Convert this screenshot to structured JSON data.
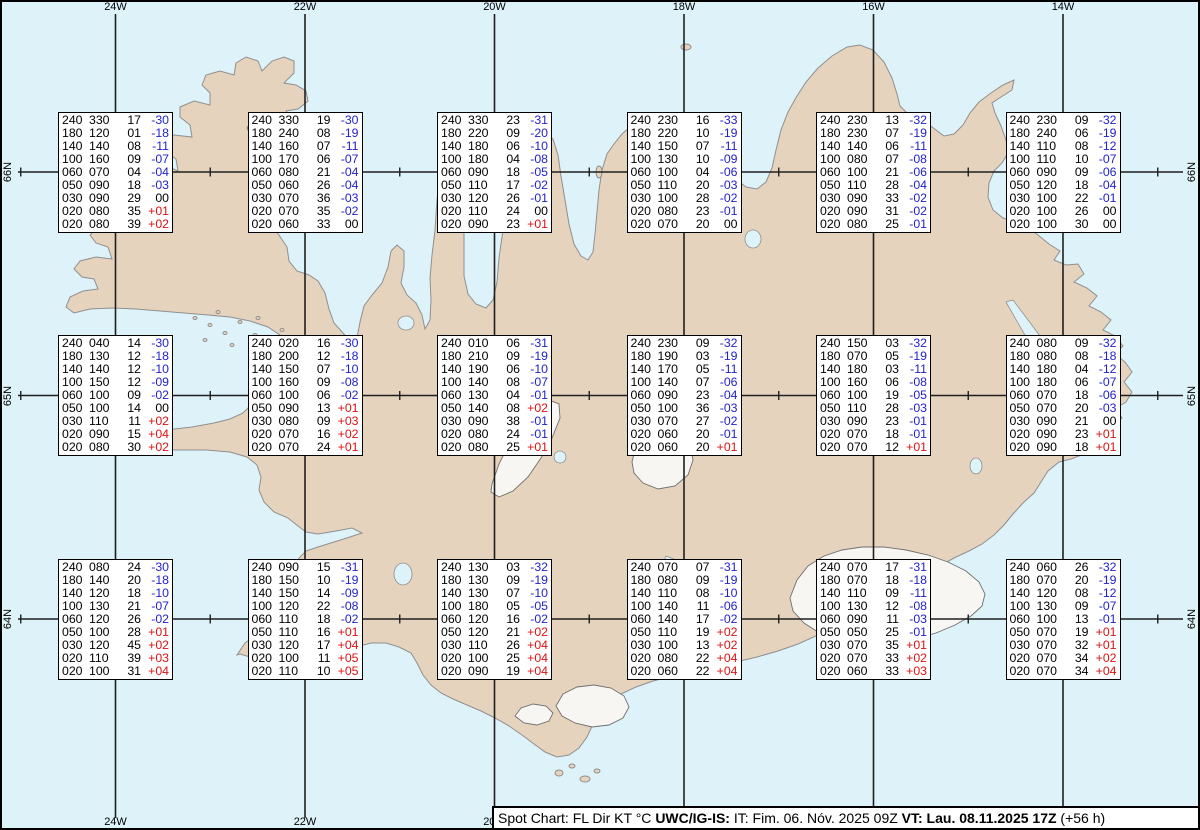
{
  "title": "Spot Chart Iceland",
  "colors": {
    "sea": "#def2f9",
    "land": "#e6d3be",
    "coastline": "#8f8f8f",
    "glacier_outline": "#6f6f6f",
    "glacier_fill": "#f7f6f2",
    "grid_line": "#1f1f1f",
    "box_background": "#ffffff",
    "box_border": "#000000",
    "text": "#000000",
    "temp_negative": "#2222cc",
    "temp_positive": "#dd1111"
  },
  "grid": {
    "meridians": [
      {
        "label": "24W",
        "x": 115.5
      },
      {
        "label": "22W",
        "x": 305
      },
      {
        "label": "20W",
        "x": 494.5
      },
      {
        "label": "18W",
        "x": 684
      },
      {
        "label": "16W",
        "x": 873.5
      },
      {
        "label": "14W",
        "x": 1063
      }
    ],
    "parallels": [
      {
        "label": "66N",
        "y": 172
      },
      {
        "label": "65N",
        "y": 395.5
      },
      {
        "label": "64N",
        "y": 619
      }
    ],
    "meridian_y1": 14,
    "meridian_y2": 818,
    "parallel_x1": 18,
    "parallel_x2": 1183,
    "tick_x": [
      20.75,
      210.25,
      399.75,
      589.25,
      778.75,
      968.25,
      1157.75
    ],
    "top_label_y": 1,
    "bottom_label_y": 816,
    "left_label_x": 8,
    "right_label_x": 1192
  },
  "columns": [
    "FL",
    "Dir",
    "KT",
    "°C"
  ],
  "stations": [
    {
      "lat": "66N",
      "lon": "24W",
      "levels": [
        [
          "240",
          "330",
          "17",
          "-30"
        ],
        [
          "180",
          "120",
          "01",
          "-18"
        ],
        [
          "140",
          "140",
          "08",
          "-11"
        ],
        [
          "100",
          "160",
          "09",
          "-07"
        ],
        [
          "060",
          "070",
          "04",
          "-04"
        ],
        [
          "050",
          "090",
          "18",
          "-03"
        ],
        [
          "030",
          "090",
          "29",
          "00"
        ],
        [
          "020",
          "080",
          "35",
          "+01"
        ],
        [
          "020",
          "080",
          "39",
          "+02"
        ]
      ]
    },
    {
      "lat": "66N",
      "lon": "22W",
      "levels": [
        [
          "240",
          "330",
          "19",
          "-30"
        ],
        [
          "180",
          "240",
          "08",
          "-19"
        ],
        [
          "140",
          "160",
          "07",
          "-11"
        ],
        [
          "100",
          "170",
          "06",
          "-07"
        ],
        [
          "060",
          "080",
          "21",
          "-04"
        ],
        [
          "050",
          "060",
          "26",
          "-04"
        ],
        [
          "030",
          "070",
          "36",
          "-03"
        ],
        [
          "020",
          "070",
          "35",
          "-02"
        ],
        [
          "020",
          "060",
          "33",
          "00"
        ]
      ]
    },
    {
      "lat": "66N",
      "lon": "20W",
      "levels": [
        [
          "240",
          "330",
          "23",
          "-31"
        ],
        [
          "180",
          "220",
          "09",
          "-20"
        ],
        [
          "140",
          "180",
          "06",
          "-10"
        ],
        [
          "100",
          "180",
          "04",
          "-08"
        ],
        [
          "060",
          "090",
          "18",
          "-05"
        ],
        [
          "050",
          "110",
          "17",
          "-02"
        ],
        [
          "030",
          "120",
          "26",
          "-01"
        ],
        [
          "020",
          "110",
          "24",
          "00"
        ],
        [
          "020",
          "090",
          "23",
          "+01"
        ]
      ]
    },
    {
      "lat": "66N",
      "lon": "18W",
      "levels": [
        [
          "240",
          "230",
          "16",
          "-33"
        ],
        [
          "180",
          "220",
          "10",
          "-19"
        ],
        [
          "140",
          "150",
          "07",
          "-11"
        ],
        [
          "100",
          "130",
          "10",
          "-09"
        ],
        [
          "060",
          "100",
          "04",
          "-06"
        ],
        [
          "050",
          "110",
          "20",
          "-03"
        ],
        [
          "030",
          "100",
          "28",
          "-02"
        ],
        [
          "020",
          "080",
          "23",
          "-01"
        ],
        [
          "020",
          "070",
          "20",
          "00"
        ]
      ]
    },
    {
      "lat": "66N",
      "lon": "16W",
      "levels": [
        [
          "240",
          "230",
          "13",
          "-32"
        ],
        [
          "180",
          "230",
          "07",
          "-19"
        ],
        [
          "140",
          "140",
          "06",
          "-11"
        ],
        [
          "100",
          "080",
          "07",
          "-08"
        ],
        [
          "060",
          "100",
          "21",
          "-06"
        ],
        [
          "050",
          "110",
          "28",
          "-04"
        ],
        [
          "030",
          "090",
          "33",
          "-02"
        ],
        [
          "020",
          "090",
          "31",
          "-02"
        ],
        [
          "020",
          "080",
          "25",
          "-01"
        ]
      ]
    },
    {
      "lat": "66N",
      "lon": "14W",
      "levels": [
        [
          "240",
          "230",
          "09",
          "-32"
        ],
        [
          "180",
          "240",
          "06",
          "-19"
        ],
        [
          "140",
          "110",
          "08",
          "-12"
        ],
        [
          "100",
          "110",
          "10",
          "-07"
        ],
        [
          "060",
          "090",
          "09",
          "-06"
        ],
        [
          "050",
          "120",
          "18",
          "-04"
        ],
        [
          "030",
          "100",
          "22",
          "-01"
        ],
        [
          "020",
          "100",
          "26",
          "00"
        ],
        [
          "020",
          "100",
          "30",
          "00"
        ]
      ]
    },
    {
      "lat": "65N",
      "lon": "24W",
      "levels": [
        [
          "240",
          "040",
          "14",
          "-30"
        ],
        [
          "180",
          "130",
          "12",
          "-18"
        ],
        [
          "140",
          "140",
          "12",
          "-10"
        ],
        [
          "100",
          "150",
          "12",
          "-09"
        ],
        [
          "060",
          "100",
          "09",
          "-02"
        ],
        [
          "050",
          "100",
          "14",
          "00"
        ],
        [
          "030",
          "110",
          "11",
          "+02"
        ],
        [
          "020",
          "090",
          "15",
          "+04"
        ],
        [
          "020",
          "080",
          "30",
          "+02"
        ]
      ]
    },
    {
      "lat": "65N",
      "lon": "22W",
      "levels": [
        [
          "240",
          "020",
          "16",
          "-30"
        ],
        [
          "180",
          "200",
          "12",
          "-18"
        ],
        [
          "140",
          "150",
          "07",
          "-10"
        ],
        [
          "100",
          "160",
          "09",
          "-08"
        ],
        [
          "060",
          "100",
          "06",
          "-02"
        ],
        [
          "050",
          "090",
          "13",
          "+01"
        ],
        [
          "030",
          "080",
          "09",
          "+03"
        ],
        [
          "020",
          "070",
          "16",
          "+02"
        ],
        [
          "020",
          "070",
          "24",
          "+01"
        ]
      ]
    },
    {
      "lat": "65N",
      "lon": "20W",
      "levels": [
        [
          "240",
          "010",
          "06",
          "-31"
        ],
        [
          "180",
          "210",
          "09",
          "-19"
        ],
        [
          "140",
          "190",
          "06",
          "-10"
        ],
        [
          "100",
          "140",
          "08",
          "-07"
        ],
        [
          "060",
          "130",
          "04",
          "-01"
        ],
        [
          "050",
          "140",
          "08",
          "+02"
        ],
        [
          "030",
          "090",
          "38",
          "-01"
        ],
        [
          "020",
          "080",
          "24",
          "-01"
        ],
        [
          "020",
          "080",
          "25",
          "+01"
        ]
      ]
    },
    {
      "lat": "65N",
      "lon": "18W",
      "levels": [
        [
          "240",
          "230",
          "09",
          "-32"
        ],
        [
          "180",
          "190",
          "03",
          "-19"
        ],
        [
          "140",
          "170",
          "05",
          "-11"
        ],
        [
          "100",
          "140",
          "07",
          "-06"
        ],
        [
          "060",
          "090",
          "23",
          "-04"
        ],
        [
          "050",
          "100",
          "36",
          "-03"
        ],
        [
          "030",
          "070",
          "27",
          "-02"
        ],
        [
          "020",
          "060",
          "20",
          "-01"
        ],
        [
          "020",
          "060",
          "20",
          "+01"
        ]
      ]
    },
    {
      "lat": "65N",
      "lon": "16W",
      "levels": [
        [
          "240",
          "150",
          "03",
          "-32"
        ],
        [
          "180",
          "070",
          "05",
          "-19"
        ],
        [
          "140",
          "180",
          "03",
          "-11"
        ],
        [
          "100",
          "160",
          "06",
          "-08"
        ],
        [
          "060",
          "100",
          "19",
          "-05"
        ],
        [
          "050",
          "110",
          "28",
          "-03"
        ],
        [
          "030",
          "090",
          "23",
          "-01"
        ],
        [
          "020",
          "070",
          "18",
          "-01"
        ],
        [
          "020",
          "070",
          "12",
          "+01"
        ]
      ]
    },
    {
      "lat": "65N",
      "lon": "14W",
      "levels": [
        [
          "240",
          "080",
          "09",
          "-32"
        ],
        [
          "180",
          "080",
          "08",
          "-18"
        ],
        [
          "140",
          "180",
          "04",
          "-12"
        ],
        [
          "100",
          "180",
          "06",
          "-07"
        ],
        [
          "060",
          "070",
          "18",
          "-06"
        ],
        [
          "050",
          "070",
          "20",
          "-03"
        ],
        [
          "030",
          "090",
          "21",
          "00"
        ],
        [
          "020",
          "090",
          "23",
          "+01"
        ],
        [
          "020",
          "090",
          "18",
          "+01"
        ]
      ]
    },
    {
      "lat": "64N",
      "lon": "24W",
      "levels": [
        [
          "240",
          "080",
          "24",
          "-30"
        ],
        [
          "180",
          "140",
          "20",
          "-18"
        ],
        [
          "140",
          "120",
          "18",
          "-10"
        ],
        [
          "100",
          "130",
          "21",
          "-07"
        ],
        [
          "060",
          "120",
          "26",
          "-02"
        ],
        [
          "050",
          "100",
          "28",
          "+01"
        ],
        [
          "030",
          "120",
          "45",
          "+02"
        ],
        [
          "020",
          "110",
          "39",
          "+03"
        ],
        [
          "020",
          "100",
          "31",
          "+04"
        ]
      ]
    },
    {
      "lat": "64N",
      "lon": "22W",
      "levels": [
        [
          "240",
          "090",
          "15",
          "-31"
        ],
        [
          "180",
          "150",
          "10",
          "-19"
        ],
        [
          "140",
          "150",
          "14",
          "-09"
        ],
        [
          "100",
          "120",
          "22",
          "-08"
        ],
        [
          "060",
          "110",
          "18",
          "-02"
        ],
        [
          "050",
          "110",
          "16",
          "+01"
        ],
        [
          "030",
          "120",
          "17",
          "+04"
        ],
        [
          "020",
          "100",
          "11",
          "+05"
        ],
        [
          "020",
          "110",
          "10",
          "+05"
        ]
      ]
    },
    {
      "lat": "64N",
      "lon": "20W",
      "levels": [
        [
          "240",
          "130",
          "03",
          "-32"
        ],
        [
          "180",
          "130",
          "09",
          "-19"
        ],
        [
          "140",
          "130",
          "07",
          "-10"
        ],
        [
          "100",
          "180",
          "05",
          "-05"
        ],
        [
          "060",
          "120",
          "16",
          "-02"
        ],
        [
          "050",
          "120",
          "21",
          "+02"
        ],
        [
          "030",
          "110",
          "26",
          "+04"
        ],
        [
          "020",
          "100",
          "25",
          "+04"
        ],
        [
          "020",
          "090",
          "19",
          "+04"
        ]
      ]
    },
    {
      "lat": "64N",
      "lon": "18W",
      "levels": [
        [
          "240",
          "070",
          "07",
          "-31"
        ],
        [
          "180",
          "080",
          "09",
          "-19"
        ],
        [
          "140",
          "110",
          "08",
          "-10"
        ],
        [
          "100",
          "140",
          "11",
          "-06"
        ],
        [
          "060",
          "140",
          "17",
          "-02"
        ],
        [
          "050",
          "110",
          "19",
          "+02"
        ],
        [
          "030",
          "100",
          "13",
          "+02"
        ],
        [
          "020",
          "080",
          "22",
          "+04"
        ],
        [
          "020",
          "060",
          "22",
          "+04"
        ]
      ]
    },
    {
      "lat": "64N",
      "lon": "16W",
      "levels": [
        [
          "240",
          "070",
          "17",
          "-31"
        ],
        [
          "180",
          "070",
          "18",
          "-18"
        ],
        [
          "140",
          "110",
          "09",
          "-11"
        ],
        [
          "100",
          "130",
          "12",
          "-08"
        ],
        [
          "060",
          "090",
          "11",
          "-03"
        ],
        [
          "050",
          "050",
          "25",
          "-01"
        ],
        [
          "030",
          "070",
          "35",
          "+01"
        ],
        [
          "020",
          "070",
          "33",
          "+02"
        ],
        [
          "020",
          "060",
          "33",
          "+03"
        ]
      ]
    },
    {
      "lat": "64N",
      "lon": "14W",
      "levels": [
        [
          "240",
          "060",
          "26",
          "-32"
        ],
        [
          "180",
          "070",
          "20",
          "-19"
        ],
        [
          "140",
          "120",
          "08",
          "-12"
        ],
        [
          "100",
          "130",
          "09",
          "-07"
        ],
        [
          "060",
          "100",
          "13",
          "-01"
        ],
        [
          "050",
          "070",
          "19",
          "+01"
        ],
        [
          "030",
          "070",
          "32",
          "+01"
        ],
        [
          "020",
          "070",
          "34",
          "+02"
        ],
        [
          "020",
          "070",
          "34",
          "+04"
        ]
      ]
    }
  ],
  "status_bar": {
    "segments": [
      {
        "text": "Spot Chart: FL Dir KT °C ",
        "bold": false
      },
      {
        "text": "UWC/IG-IS:",
        "bold": true
      },
      {
        "text": " IT: Fim. 06. Nóv. 2025 09Z ",
        "bold": false
      },
      {
        "text": "VT: Lau. 08.11.2025 17Z",
        "bold": true
      },
      {
        "text": " (+56 h)",
        "bold": false
      }
    ]
  }
}
